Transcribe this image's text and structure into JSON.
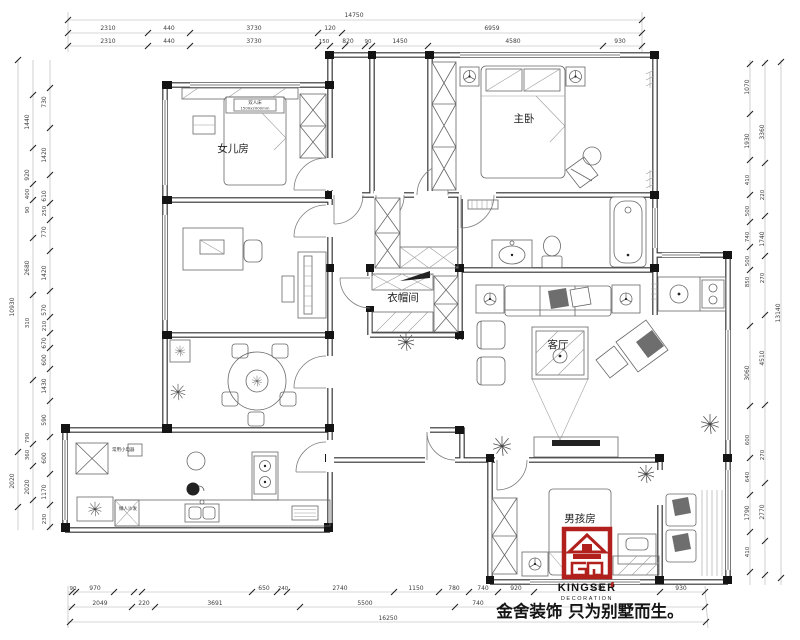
{
  "rooms": {
    "daughter": "女儿房",
    "master": "主卧",
    "cloak": "衣帽间",
    "living": "客厅",
    "boy": "男孩房"
  },
  "notes": {
    "bed_type": "双人床",
    "bed_size": "1500x2000mm",
    "kitchen_note1": "常用小电器",
    "kitchen_note2": "懒人沙发"
  },
  "logo": {
    "brand": "KINGSER",
    "sub": "DECORATION",
    "accent_color": "#b2201e"
  },
  "slogan": "金舍装饰 只为别墅而生。",
  "dims": {
    "t1": [
      "14750"
    ],
    "t2": [
      "2310",
      "440",
      "3730",
      "120",
      "6959"
    ],
    "t3": [
      "2310",
      "440",
      "3730",
      "150",
      "820",
      "90",
      "1450",
      "4580",
      "930"
    ],
    "b1": [
      "90",
      "970",
      "650",
      "240",
      "2740",
      "1150",
      "780",
      "740",
      "920",
      "3610",
      "930"
    ],
    "b2": [
      "2049",
      "220",
      "3691",
      "5500",
      "740"
    ],
    "b3": [
      "16250"
    ],
    "li": [
      "730",
      "1420",
      "610",
      "250",
      "770",
      "1420",
      "570",
      "210",
      "670",
      "600",
      "1430",
      "590",
      "600",
      "1170",
      "230"
    ],
    "lm": [
      "1440",
      "920",
      "400",
      "90",
      "2680",
      "310",
      "790",
      "360",
      "2020"
    ],
    "lo": [
      "10930",
      "2020"
    ],
    "ri": [
      "1070",
      "1930",
      "410",
      "500",
      "740",
      "500",
      "850",
      "3060",
      "600",
      "640",
      "1790",
      "410"
    ],
    "rm": [
      "3360",
      "220",
      "1740",
      "270",
      "4510",
      "270",
      "2770"
    ],
    "ro": [
      "13140"
    ]
  }
}
